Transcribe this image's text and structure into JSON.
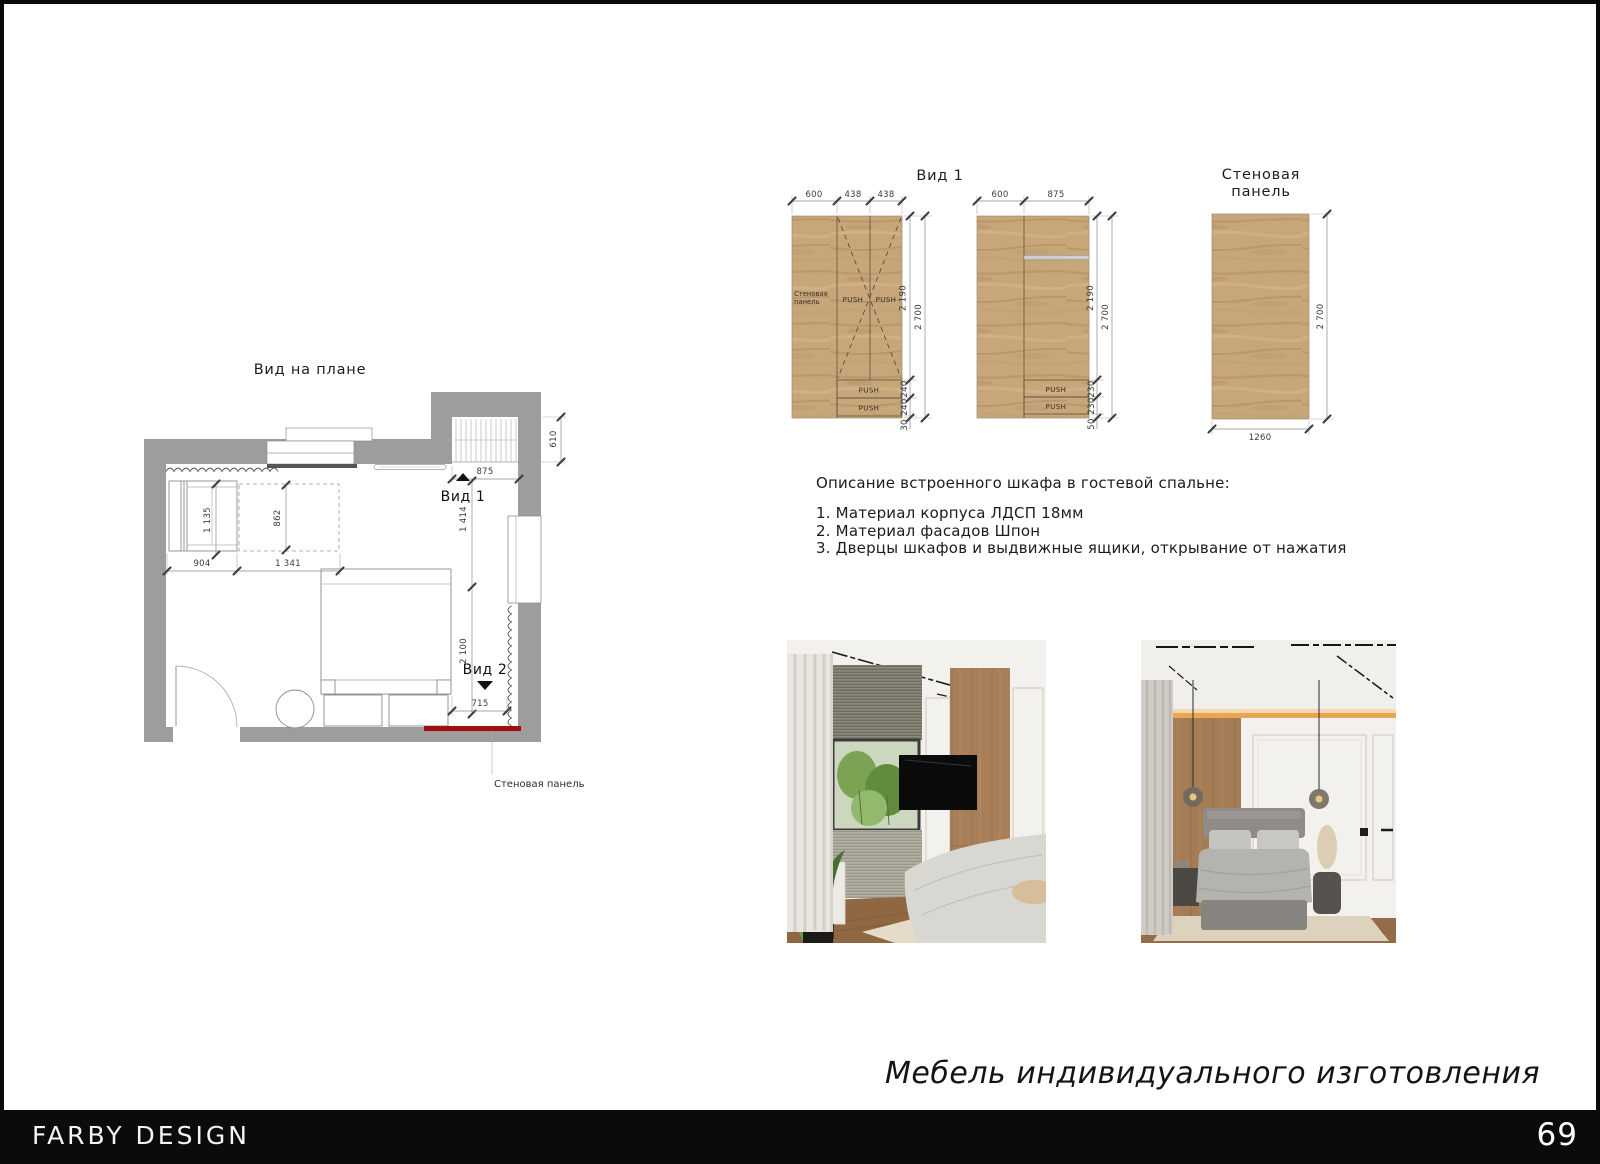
{
  "labels": {
    "push": "PUSH",
    "view1": "Вид 1",
    "view2": "Вид 2",
    "wall_panel": "Стеновая панель",
    "wall_panel_l1": "Стеновая",
    "wall_panel_l2": "панель"
  },
  "plan": {
    "title": "Вид на плане",
    "dims": {
      "closet_width": "875",
      "closet_depth": "610",
      "wardrobe_depth": "1 135",
      "wardrobe_width": "904",
      "niche_depth": "862",
      "niche_width": "1 341",
      "right_upper": "1 414",
      "right_lower": "2 100",
      "panel_width": "715"
    }
  },
  "view1": {
    "title": "Вид 1",
    "elev_a": {
      "dims_top": [
        "600",
        "438",
        "438"
      ],
      "dim_door": "2 190",
      "dim_total": "2 700",
      "dims_drawers": [
        "240",
        "240",
        "30"
      ]
    },
    "elev_b": {
      "dims_top": [
        "600",
        "875"
      ],
      "dim_door": "2 190",
      "dim_total": "2 700",
      "dims_drawers": [
        "230",
        "230",
        "50"
      ]
    }
  },
  "wall_panel": {
    "title_l1": "Стеновая",
    "title_l2": "панель",
    "dim_width": "1260",
    "dim_height": "2 700"
  },
  "description": {
    "heading": "Описание встроенного шкафа в гостевой спальне:",
    "items": [
      "1. Материал корпуса ЛДСП 18мм",
      "2. Материал фасадов Шпон",
      "3. Дверцы шкафов и выдвижные ящики, открывание от нажатия"
    ]
  },
  "tagline": "Мебель индивидуального изготовления",
  "footer": {
    "brand": "FARBY DESIGN",
    "page_number": "69"
  }
}
